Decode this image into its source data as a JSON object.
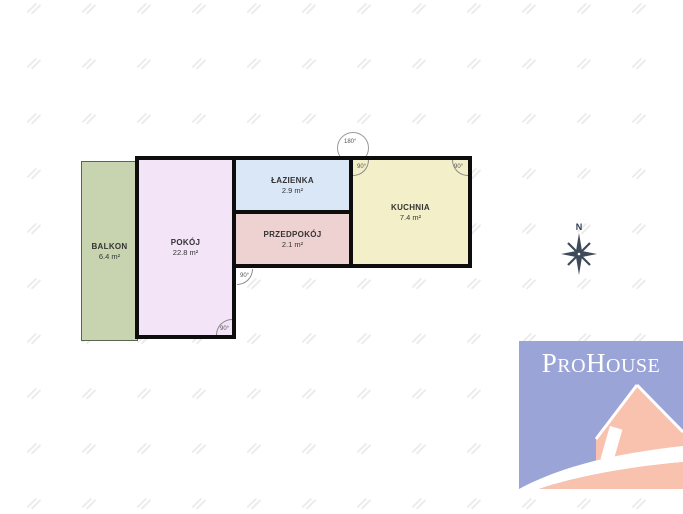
{
  "floorplan": {
    "rooms": [
      {
        "name": "BALKON",
        "area": "6.4 m²",
        "color": "#c8d4af"
      },
      {
        "name": "POKÓJ",
        "area": "22.8 m²",
        "color": "#f4e4f8"
      },
      {
        "name": "ŁAZIENKA",
        "area": "2.9 m²",
        "color": "#d9e7f7"
      },
      {
        "name": "PRZEDPOKÓJ",
        "area": "2.1 m²",
        "color": "#eed2d1"
      },
      {
        "name": "KUCHNIA",
        "area": "7.4 m²",
        "color": "#f3f0c9"
      }
    ],
    "angles": {
      "top": "180°",
      "kitchen_tl": "90°",
      "kitchen_tr": "90°",
      "room_br": "90°",
      "hall_bl": "90°"
    },
    "wall_color": "#0d0d0d"
  },
  "compass": {
    "north_label": "N",
    "color": "#3e4a5a"
  },
  "logo": {
    "brand": "ProHouse",
    "part1": "P",
    "part2": "RO",
    "part3": "H",
    "part4": "OUSE",
    "bg_color": "#9aa4d6",
    "house_color": "#f9c2ae",
    "text_color": "#ffffff"
  }
}
